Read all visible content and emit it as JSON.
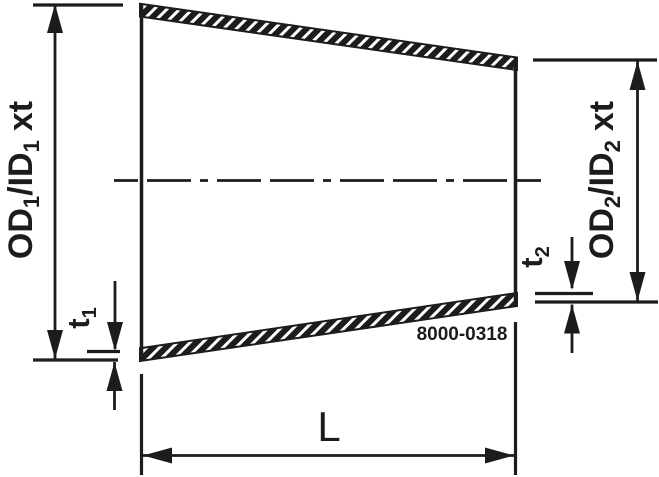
{
  "drawing": {
    "part_number": "8000-0318",
    "labels": {
      "od1": {
        "p1": "OD",
        "sub1": "1",
        "p2": "/ID",
        "sub2": "1",
        "p3": "xt"
      },
      "od2": {
        "p1": "OD",
        "sub1": "2",
        "p2": "/ID",
        "sub2": "2",
        "p3": "xt"
      },
      "t1": {
        "p1": "t",
        "sub1": "1"
      },
      "t2": {
        "p1": "t",
        "sub1": "2"
      },
      "length": "L"
    },
    "colors": {
      "ink": "#1c1c1c",
      "background": "#ffffff"
    }
  }
}
